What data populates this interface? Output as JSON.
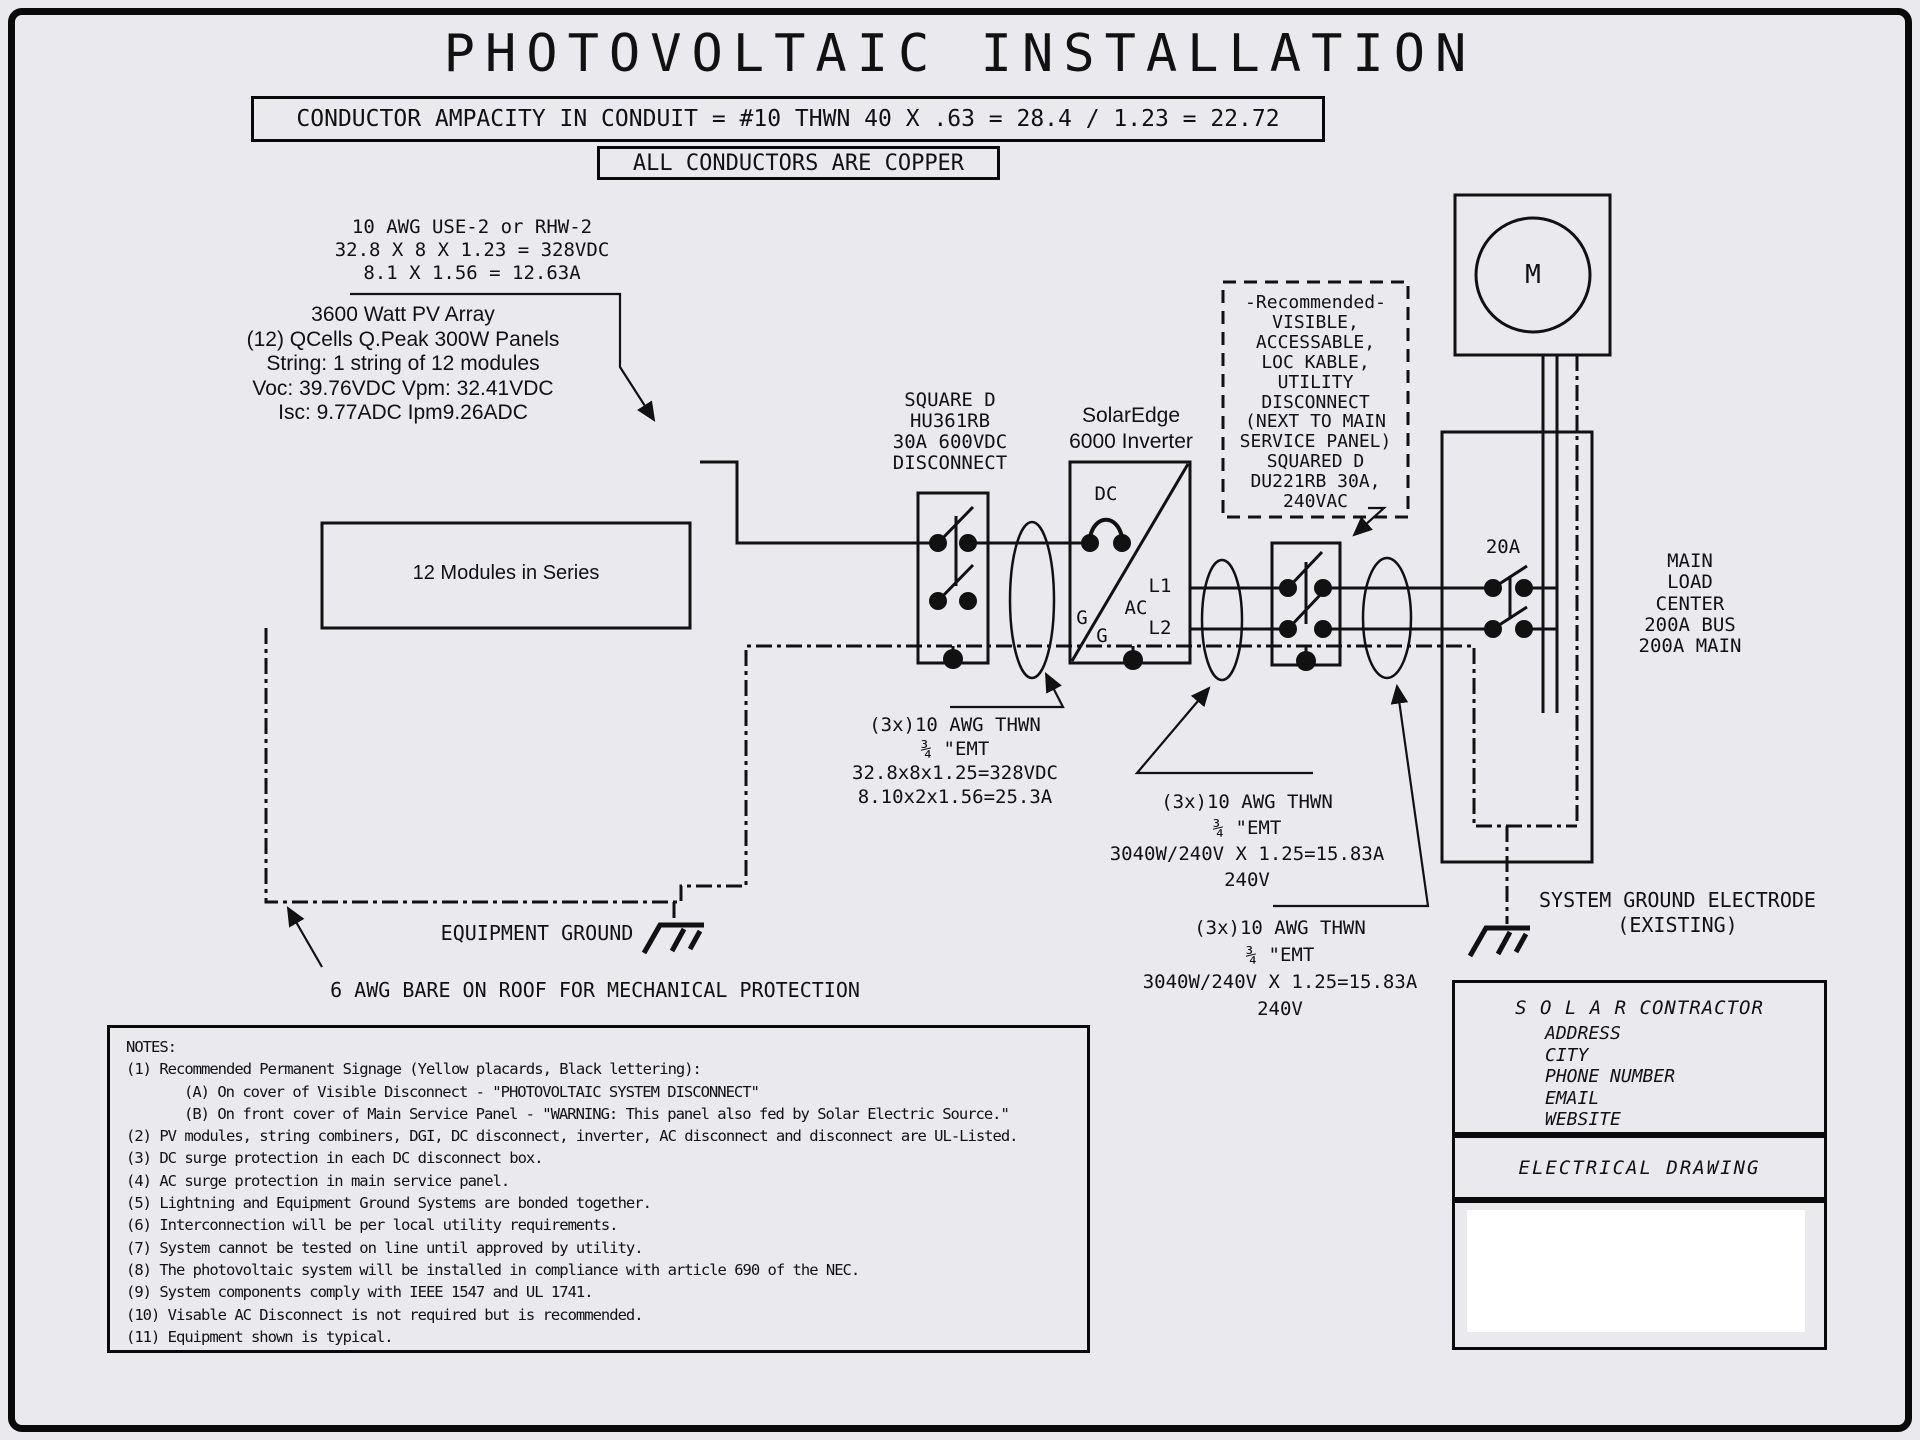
{
  "colors": {
    "background": "#e9e9ee",
    "line": "#111111",
    "panel": "#ffffff"
  },
  "title": "PHOTOVOLTAIC INSTALLATION",
  "banner_ampacity": "CONDUCTOR AMPACITY IN CONDUIT = #10 THWN 40 X .63 = 28.4 / 1.23 = 22.72",
  "banner_copper": "ALL CONDUCTORS ARE COPPER",
  "array_calc": [
    "10 AWG USE-2 or RHW-2",
    "32.8 X 8 X 1.23 = 328VDC",
    "8.1 X 1.56 = 12.63A"
  ],
  "pv_array": [
    "3600 Watt PV Array",
    "(12) QCells Q.Peak 300W Panels",
    "String: 1 string of 12 modules",
    "Voc: 39.76VDC  Vpm: 32.41VDC",
    "Isc: 9.77ADC  Ipm9.26ADC"
  ],
  "modules_label": "12 Modules in Series",
  "dc_disconnect": [
    "SQUARE D",
    "HU361RB",
    "30A 600VDC",
    "DISCONNECT"
  ],
  "inverter_label": [
    "SolarEdge",
    "6000 Inverter"
  ],
  "inverter_marks": {
    "dc": "DC",
    "ac": "AC",
    "l1": "L1",
    "l2": "L2",
    "g1": "G",
    "g2": "G"
  },
  "recommended": [
    "-Recommended-",
    "VISIBLE,",
    "ACCESSABLE,",
    "LOC KABLE,",
    "UTILITY",
    "DISCONNECT",
    "(NEXT TO MAIN",
    "SERVICE PANEL)",
    "SQUARED D",
    "DU221RB 30A,",
    "240VAC"
  ],
  "meter_mark": "M",
  "breaker_label": "20A",
  "load_center": [
    "MAIN",
    "LOAD",
    "CENTER",
    "200A BUS",
    "200A MAIN"
  ],
  "conduit_dc": [
    "(3x)10 AWG THWN",
    "¾ \"EMT",
    "32.8x8x1.25=328VDC",
    "8.10x2x1.56=25.3A"
  ],
  "conduit_ac1": [
    "(3x)10 AWG THWN",
    "¾ \"EMT",
    "3040W/240V X 1.25=15.83A",
    "240V"
  ],
  "conduit_ac2": [
    "(3x)10 AWG THWN",
    "¾ \"EMT",
    "3040W/240V X 1.25=15.83A",
    "240V"
  ],
  "equipment_ground": "EQUIPMENT GROUND",
  "roof_note": "6 AWG BARE ON ROOF FOR MECHANICAL PROTECTION",
  "system_ground": [
    "SYSTEM GROUND ELECTRODE",
    "(EXISTING)"
  ],
  "contractor": {
    "title": "S O L A R  CONTRACTOR",
    "lines": [
      "ADDRESS",
      "CITY",
      "PHONE NUMBER",
      "EMAIL",
      "WEBSITE"
    ],
    "section": "ELECTRICAL DRAWING"
  },
  "notes": {
    "heading": "NOTES:",
    "lines": [
      "(1) Recommended Permanent Signage (Yellow placards, Black lettering):",
      "(A) On cover of Visible Disconnect - \"PHOTOVOLTAIC SYSTEM DISCONNECT\"",
      "(B) On front cover of Main Service Panel - \"WARNING: This panel also fed by Solar Electric Source.\"",
      "(2) PV modules, string combiners, DGI, DC disconnect, inverter, AC disconnect and disconnect are UL-Listed.",
      "(3) DC surge protection in each DC disconnect box.",
      "(4) AC surge protection in main service panel.",
      "(5) Lightning and Equipment Ground Systems are bonded together.",
      "(6) Interconnection will be per local utility requirements.",
      "(7) System cannot be tested on line until approved by utility.",
      "(8) The photovoltaic system will be installed in compliance with article 690 of the NEC.",
      "(9) System components comply with IEEE 1547 and UL 1741.",
      "(10) Visable AC Disconnect is not required but is recommended.",
      "(11) Equipment shown is typical."
    ]
  }
}
